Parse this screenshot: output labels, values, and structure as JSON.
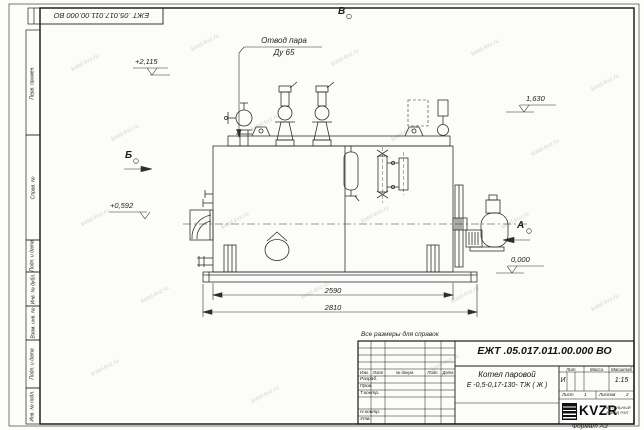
{
  "sheet": {
    "watermark": "kotel-kvz.ru",
    "format_label": "Формат А3",
    "reference_note": "Все размеры для справок",
    "corner_stamp": "ЕЖТ .05.017.011.00.000  ВО"
  },
  "margin_stamps": {
    "perv_primen": "Перв. примен.",
    "sprav_n": "Справ. №",
    "podp_data_1": "Подп. и дата",
    "inv_dubl": "Инв. № дубл.",
    "vzam_inv": "Взам. инв. №",
    "podp_data_2": "Подп. и дата",
    "inv_podl": "Инв. № подл."
  },
  "annotations": {
    "steam_outlet": {
      "line1": "Отвод пара",
      "line2": "Ду 65"
    },
    "view_top": "В",
    "view_left": "Б",
    "view_right": "А",
    "elev_top": "+2,115",
    "elev_right_upper": "1,630",
    "elev_left": "+0,592",
    "elev_right_lower": "0,000",
    "dim_boiler_length": "2590",
    "dim_total_length": "2810"
  },
  "title_block": {
    "designation": "ЕЖТ .05.017.011.00.000  ВО",
    "product_line1": "Котел паровой",
    "product_line2": "Е -0,5-0,17-130- ТЖ ( Ж )",
    "header_cols": [
      "Изм.",
      "Лист",
      "№ докум.",
      "Подп.",
      "Дата"
    ],
    "sign_rows": [
      "Разраб.",
      "Пров.",
      "Т.контр.",
      "Н.контр.",
      "Утв."
    ],
    "lit_label": "Лит.",
    "mass_label": "Масса",
    "scale_label": "Масштаб",
    "lit_value": "И",
    "scale_value": "1:15",
    "sheet_label": "Лист",
    "sheet_value": "1",
    "sheets_label": "Листов",
    "sheets_value": "2",
    "logo_text": "KVZR",
    "company_line1": "КОТЕЛЬНЫЙ",
    "company_line2": "ЗАВОД РЭП"
  }
}
